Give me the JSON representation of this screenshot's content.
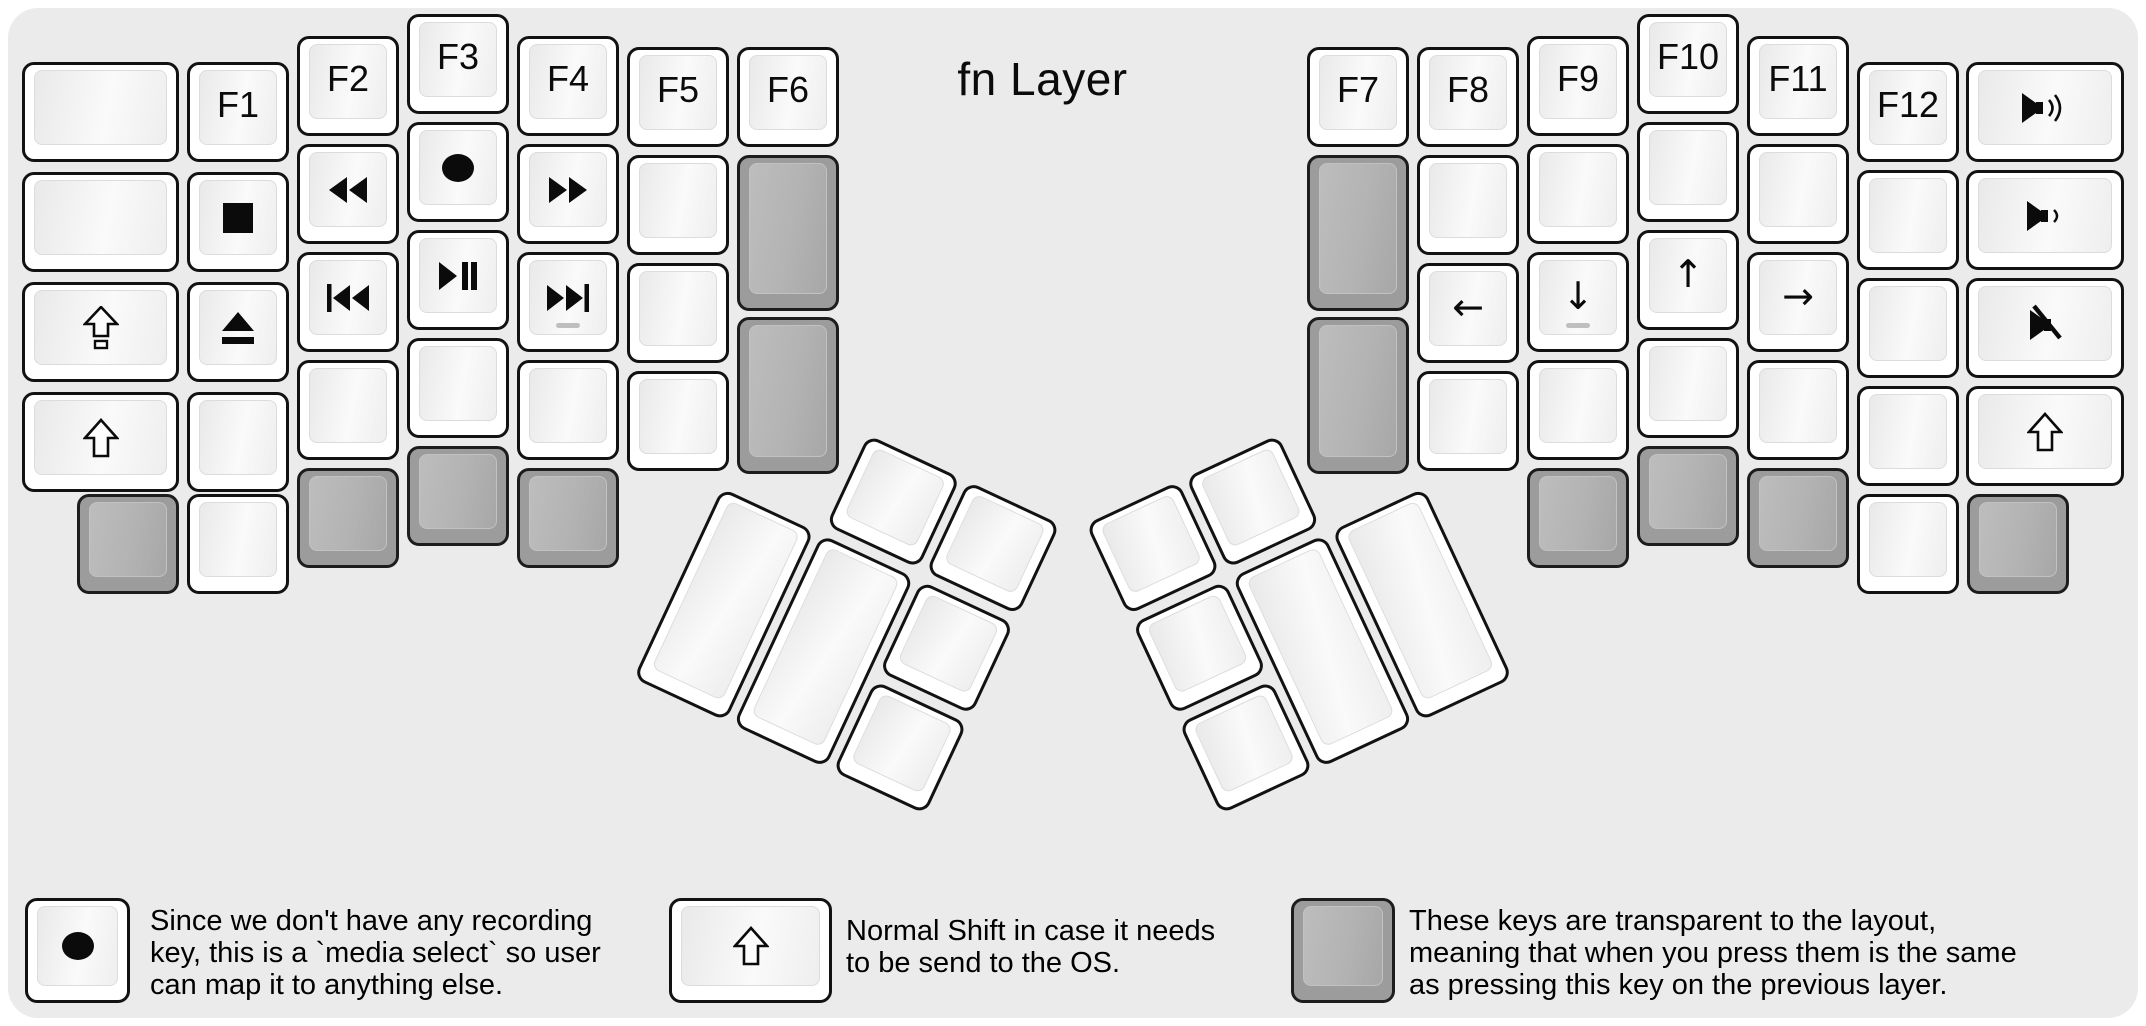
{
  "title": "fn Layer",
  "colors": {
    "page_bg": "#ffffff",
    "panel_bg": "#ebebeb",
    "key_white": "#ffffff",
    "key_gray": "#9c9c9c",
    "key_border": "#121212",
    "text": "#000000"
  },
  "keyboard": {
    "left_main": {
      "keys": [
        {
          "x": 22,
          "y": 62,
          "w": 157
        },
        {
          "x": 22,
          "y": 172,
          "w": 157
        },
        {
          "x": 22,
          "y": 282,
          "w": 157,
          "icon": "caps-lock"
        },
        {
          "x": 22,
          "y": 392,
          "w": 157,
          "icon": "shift"
        },
        {
          "x": 187,
          "y": 62,
          "label": "F1"
        },
        {
          "x": 187,
          "y": 172,
          "icon": "stop"
        },
        {
          "x": 187,
          "y": 282,
          "icon": "eject"
        },
        {
          "x": 187,
          "y": 392
        },
        {
          "x": 297,
          "y": 36,
          "label": "F2"
        },
        {
          "x": 297,
          "y": 144,
          "icon": "rewind"
        },
        {
          "x": 297,
          "y": 252,
          "icon": "prev-track"
        },
        {
          "x": 297,
          "y": 360
        },
        {
          "x": 407,
          "y": 14,
          "label": "F3"
        },
        {
          "x": 407,
          "y": 122,
          "icon": "record"
        },
        {
          "x": 407,
          "y": 230,
          "icon": "play-pause"
        },
        {
          "x": 407,
          "y": 338
        },
        {
          "x": 517,
          "y": 36,
          "label": "F4"
        },
        {
          "x": 517,
          "y": 144,
          "icon": "fast-forward"
        },
        {
          "x": 517,
          "y": 252,
          "icon": "next-track",
          "homing": true
        },
        {
          "x": 517,
          "y": 360
        },
        {
          "x": 627,
          "y": 47,
          "label": "F5"
        },
        {
          "x": 627,
          "y": 155
        },
        {
          "x": 627,
          "y": 263
        },
        {
          "x": 627,
          "y": 371
        },
        {
          "x": 737,
          "y": 47,
          "label": "F6"
        },
        {
          "x": 737,
          "y": 155,
          "h": 156,
          "gray": true
        },
        {
          "x": 737,
          "y": 317,
          "h": 157,
          "gray": true
        },
        {
          "x": 77,
          "y": 494,
          "gray": true
        },
        {
          "x": 187,
          "y": 494
        },
        {
          "x": 297,
          "y": 468,
          "gray": true
        },
        {
          "x": 407,
          "y": 446,
          "gray": true
        },
        {
          "x": 517,
          "y": 468,
          "gray": true
        }
      ]
    },
    "right_main": {
      "keys": [
        {
          "x": 1307,
          "y": 47,
          "label": "F7"
        },
        {
          "x": 1307,
          "y": 155,
          "h": 156,
          "gray": true
        },
        {
          "x": 1307,
          "y": 317,
          "h": 157,
          "gray": true
        },
        {
          "x": 1417,
          "y": 47,
          "label": "F8"
        },
        {
          "x": 1417,
          "y": 155
        },
        {
          "x": 1417,
          "y": 263,
          "icon": "arrow-left"
        },
        {
          "x": 1417,
          "y": 371
        },
        {
          "x": 1527,
          "y": 36,
          "label": "F9"
        },
        {
          "x": 1527,
          "y": 144
        },
        {
          "x": 1527,
          "y": 252,
          "icon": "arrow-down",
          "homing": true
        },
        {
          "x": 1527,
          "y": 360
        },
        {
          "x": 1637,
          "y": 14,
          "label": "F10"
        },
        {
          "x": 1637,
          "y": 122
        },
        {
          "x": 1637,
          "y": 230,
          "icon": "arrow-up"
        },
        {
          "x": 1637,
          "y": 338
        },
        {
          "x": 1747,
          "y": 36,
          "label": "F11"
        },
        {
          "x": 1747,
          "y": 144
        },
        {
          "x": 1747,
          "y": 252,
          "icon": "arrow-right"
        },
        {
          "x": 1747,
          "y": 360
        },
        {
          "x": 1857,
          "y": 62,
          "label": "F12"
        },
        {
          "x": 1857,
          "y": 170
        },
        {
          "x": 1857,
          "y": 278
        },
        {
          "x": 1857,
          "y": 386
        },
        {
          "x": 1966,
          "y": 62,
          "w": 158,
          "icon": "volume-up"
        },
        {
          "x": 1966,
          "y": 170,
          "w": 158,
          "icon": "volume-down"
        },
        {
          "x": 1966,
          "y": 278,
          "w": 158,
          "icon": "mute"
        },
        {
          "x": 1966,
          "y": 386,
          "w": 158,
          "icon": "shift"
        },
        {
          "x": 1527,
          "y": 468,
          "gray": true
        },
        {
          "x": 1637,
          "y": 446,
          "gray": true
        },
        {
          "x": 1747,
          "y": 468,
          "gray": true
        },
        {
          "x": 1857,
          "y": 494
        },
        {
          "x": 1967,
          "y": 494,
          "gray": true
        }
      ]
    },
    "left_thumb": {
      "x": 767,
      "y": 382,
      "angle": 25,
      "origin": "0 0",
      "keys": [
        {
          "x": 114,
          "y": 5
        },
        {
          "x": 224,
          "y": 5
        },
        {
          "x": 4,
          "y": 115,
          "h": 210
        },
        {
          "x": 114,
          "y": 115,
          "h": 210
        },
        {
          "x": 224,
          "y": 115
        },
        {
          "x": 224,
          "y": 225
        }
      ]
    },
    "right_thumb": {
      "x": 1049,
      "y": 382,
      "angle": -25,
      "origin": "100% 0",
      "keys": [
        {
          "x": 4,
          "y": 5
        },
        {
          "x": 114,
          "y": 5
        },
        {
          "x": 114,
          "y": 115,
          "h": 210
        },
        {
          "x": 224,
          "y": 115,
          "h": 210
        },
        {
          "x": 4,
          "y": 115
        },
        {
          "x": 4,
          "y": 225
        }
      ]
    }
  },
  "legends": [
    {
      "key": {
        "w": 105,
        "h": 105,
        "icon": "record"
      },
      "x": 25,
      "y": 898,
      "text_x": 150,
      "text_y": 905,
      "lines": [
        "Since we don't have any recording",
        "key, this is a `media select` so user",
        "can map it to anything else."
      ]
    },
    {
      "key": {
        "w": 163,
        "h": 105,
        "icon": "shift"
      },
      "x": 669,
      "y": 898,
      "text_x": 846,
      "text_y": 915,
      "lines": [
        "Normal Shift in case it needs",
        "to be send to the OS."
      ]
    },
    {
      "key": {
        "w": 104,
        "h": 105,
        "gray": true
      },
      "x": 1291,
      "y": 898,
      "text_x": 1409,
      "text_y": 905,
      "lines": [
        "These keys are transparent to the layout,",
        "meaning that when you press them is the same",
        "as pressing this key on the previous layer."
      ]
    }
  ]
}
